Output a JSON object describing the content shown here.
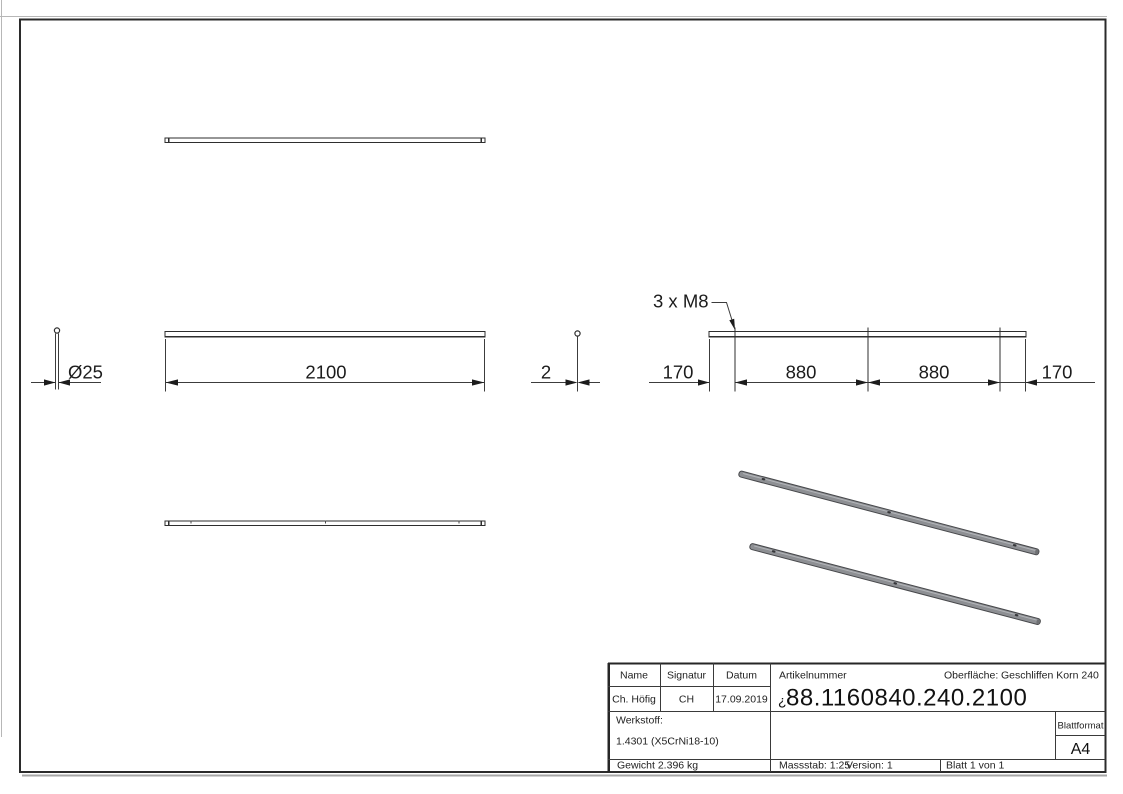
{
  "dimensions": {
    "diameter": "Ø25",
    "thickness": "2",
    "length": "2100",
    "thread_note": "3 x M8",
    "segments": [
      "170",
      "880",
      "880",
      "170"
    ]
  },
  "title_block": {
    "headers": {
      "name": "Name",
      "signature": "Signatur",
      "date": "Datum"
    },
    "values": {
      "name": "Ch. Höfig",
      "signature": "CH",
      "date": "17.09.2019"
    },
    "article": {
      "label": "Artikelnummer",
      "prefix": "¿",
      "number": "88.1160840.240.2100"
    },
    "surface": {
      "label": "Oberfläche:",
      "value": "Geschliffen Korn 240"
    },
    "material": {
      "label": "Werkstoff:",
      "value": "1.4301 (X5CrNi18-10)"
    },
    "weight": "Gewicht 2.396 kg",
    "scale": "Massstab: 1:25",
    "version": "Version: 1",
    "sheet": "Blatt 1 von 1",
    "format": {
      "label": "Blattformat",
      "value": "A4"
    }
  },
  "colors": {
    "line": "#2e2e2e",
    "tube_fill": "#8d8f93",
    "tube_edge": "#47484b",
    "page_edge": "#b7b7b7"
  }
}
